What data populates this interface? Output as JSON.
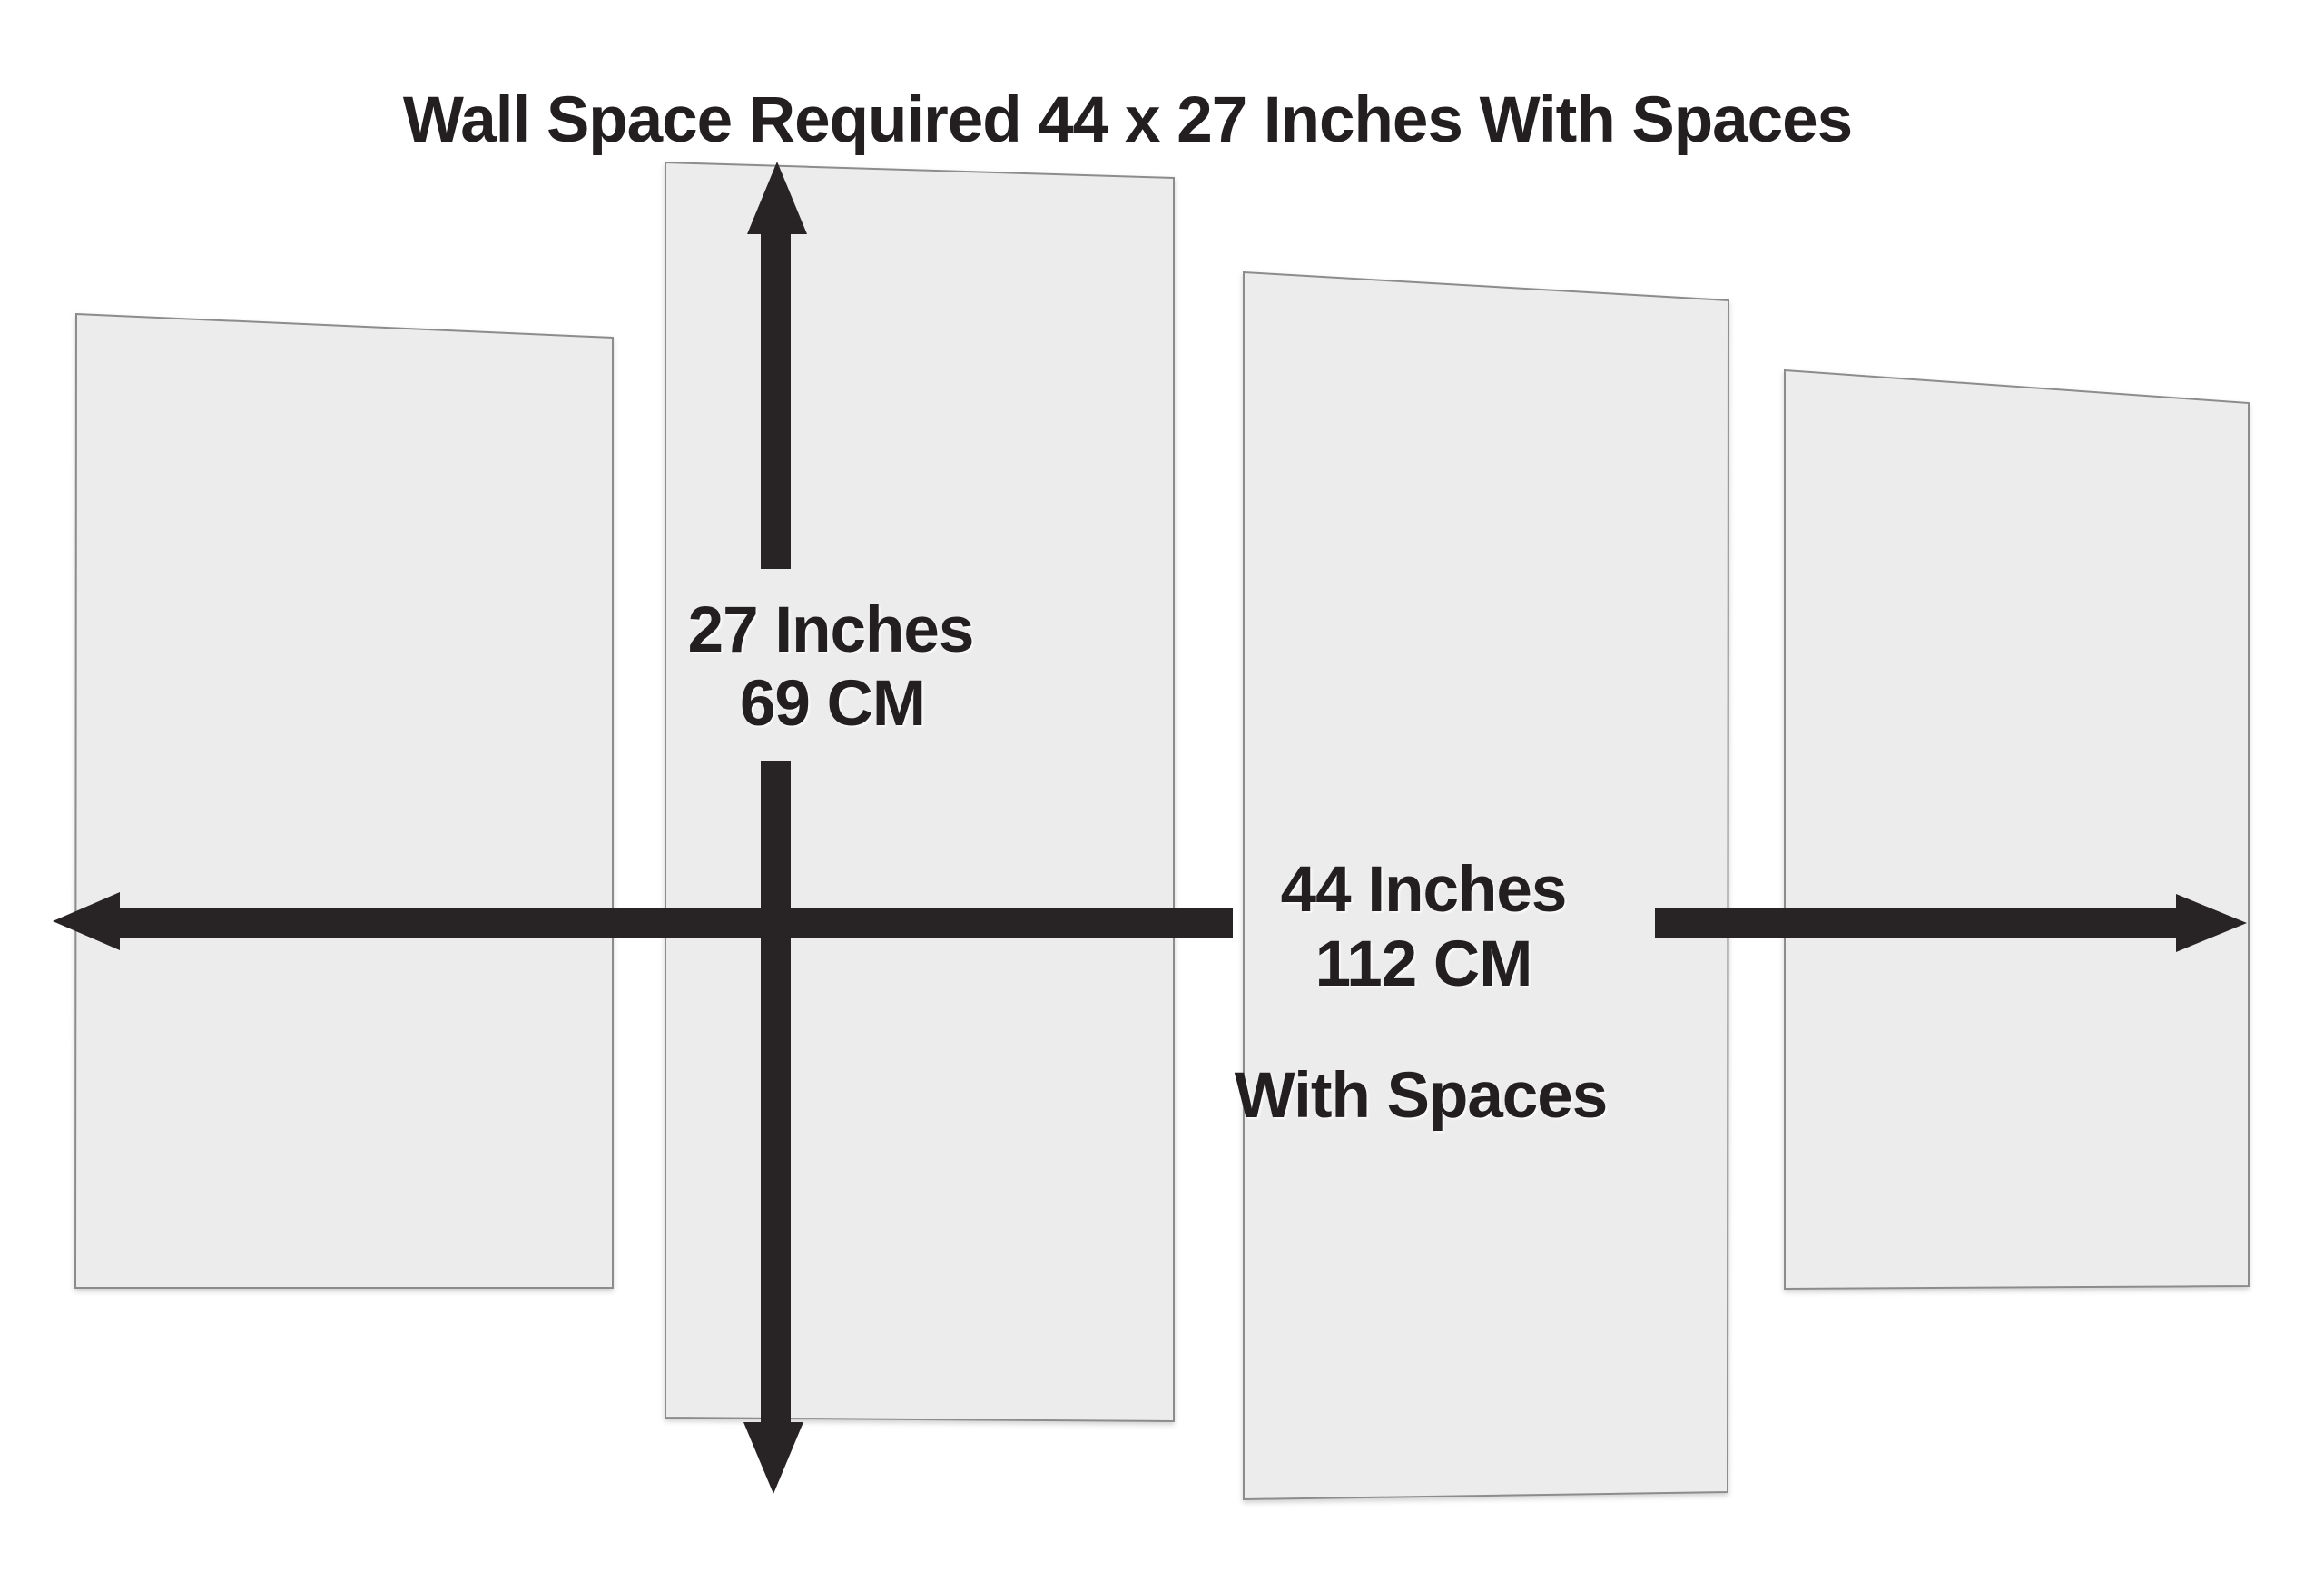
{
  "title": {
    "text": "Wall Space Required 44 x 27 Inches With Spaces"
  },
  "vertical_dimension": {
    "inches_label": "27 Inches",
    "cm_label": "69 CM"
  },
  "horizontal_dimension": {
    "inches_label": "44 Inches",
    "cm_label": "112 CM",
    "note": "With Spaces"
  },
  "panels": [
    {
      "name": "panel-1-left"
    },
    {
      "name": "panel-2-center-left"
    },
    {
      "name": "panel-3-center-right"
    },
    {
      "name": "panel-4-right"
    }
  ],
  "colors": {
    "background": "#ffffff",
    "panel_fill": "#ececec",
    "panel_border": "#8c8c8c",
    "arrow": "#282324",
    "text": "#231f20"
  },
  "dimensions": {
    "width_inches": 44,
    "width_cm": 112,
    "height_inches": 27,
    "height_cm": 69,
    "panel_count": 4
  }
}
